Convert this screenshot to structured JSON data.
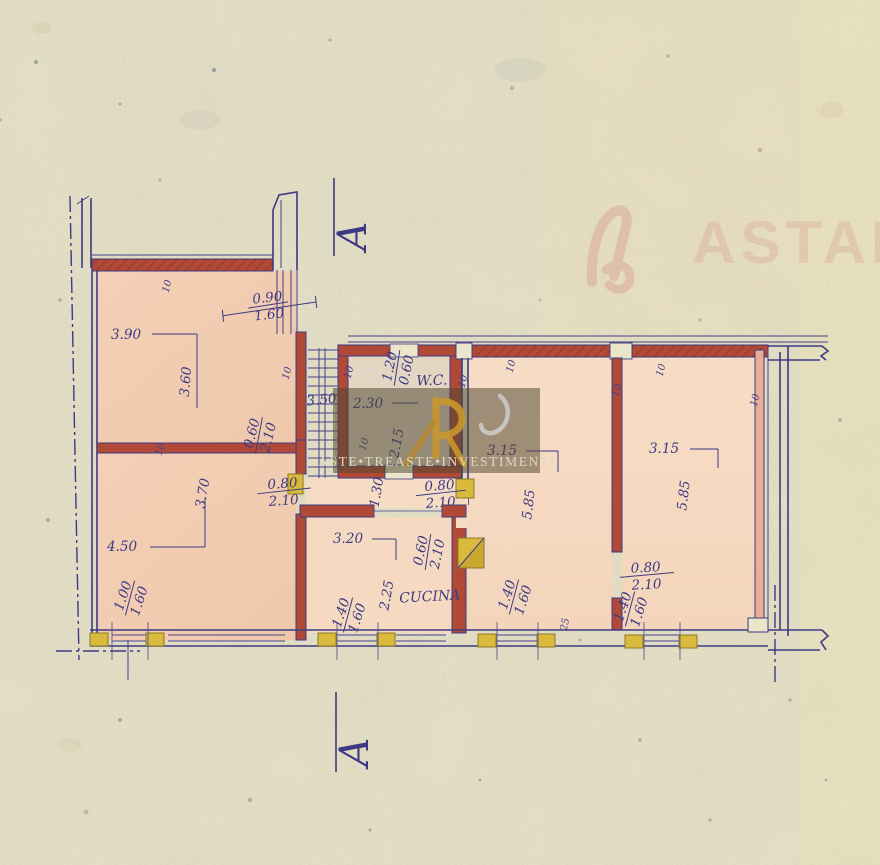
{
  "watermarks": {
    "corner_text": "ASTAL",
    "center_text": "ASTE•TREASTE•INVESTIMENTI"
  },
  "section": {
    "letter": "A"
  },
  "rooms": {
    "wc": "W.C.",
    "kitchen": "CUCINA"
  },
  "dims": {
    "win_top_num": "0.90",
    "win_top_den": "1.60",
    "room1_w": "3.90",
    "room1_h": "3.60",
    "room2_w": "4.50",
    "room2_h": "3.70",
    "door_left_num": "0.80",
    "door_left_den": "2.10",
    "door_center_num": "0.60",
    "door_center_den": "2.10",
    "stairs": "3.50",
    "wc_w": "2.30",
    "wc_h": "2.15",
    "wc_win_num": "1.20",
    "wc_win_den": "0.60",
    "hall": "1.30",
    "door_mid_num": "0.80",
    "door_mid_den": "2.10",
    "kitchen_w": "3.20",
    "kitchen_h": "2.25",
    "kitchen_door_num": "0.60",
    "kitchen_door_den": "2.10",
    "mid_w": "3.15",
    "mid_h": "5.85",
    "right_w": "3.15",
    "right_h": "5.85",
    "door_right_num": "0.80",
    "door_right_den": "2.10",
    "win_bl_num": "1.00",
    "win_bl_den": "1.60",
    "win_k_num": "1.40",
    "win_k_den": "1.60",
    "win_m_num": "1.40",
    "win_m_den": "1.60",
    "win_r_num": "1.40",
    "win_r_den": "1.60",
    "wall10": "10",
    "wall25": "25"
  },
  "colors": {
    "paper": "#ebe5c9",
    "ink": "#3c3a84",
    "wall_red": "#b04a36",
    "room_fill": "#f2cfb5",
    "pillar_yellow": "#d9ba3c",
    "watermark_pink": "#dcab9c",
    "watermark_gold": "#c8982c"
  }
}
